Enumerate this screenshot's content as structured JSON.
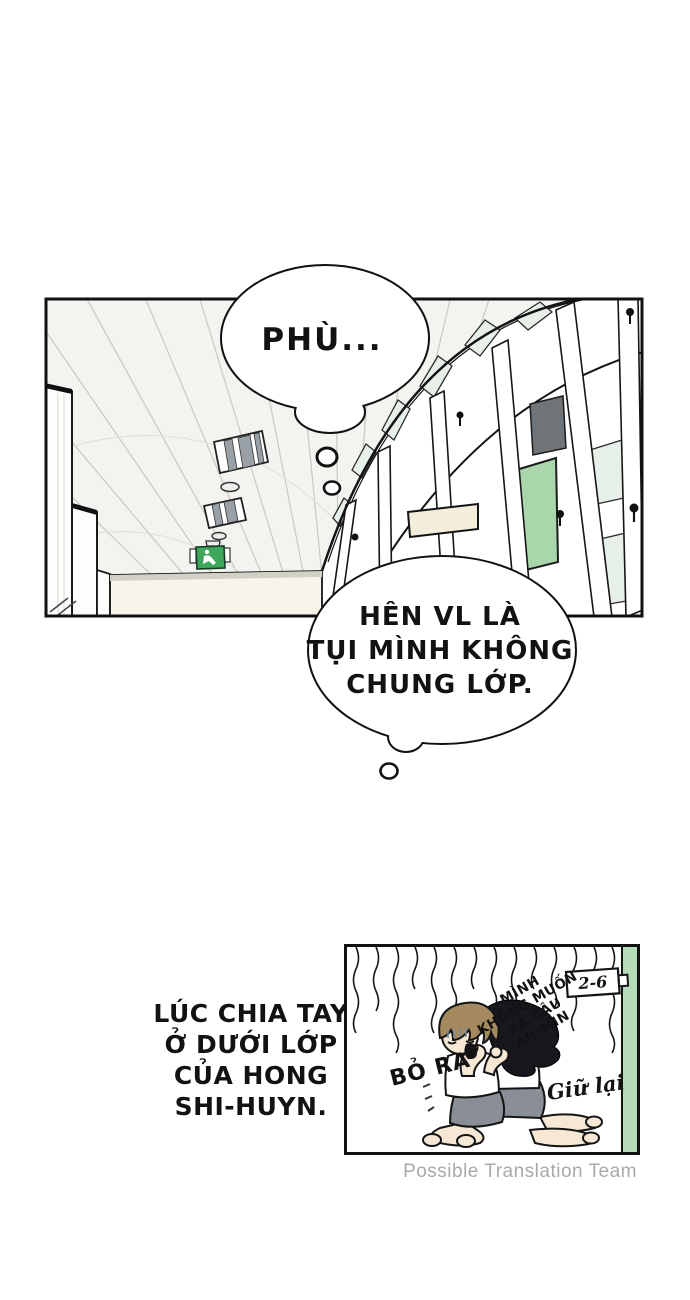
{
  "bubbles": {
    "phu": {
      "text": "PHÙ..."
    },
    "hen": {
      "lines": [
        "HÊN VL LÀ",
        "TỤI MÌNH KHÔNG",
        "CHUNG LỚP."
      ]
    }
  },
  "narration": {
    "lines": [
      "LÚC CHIA TAY",
      "Ở DƯỚI LỚP",
      "CỦA HONG",
      "SHI-HUYN."
    ]
  },
  "mini_panel": {
    "classroom_sign": "2-6",
    "clinging_text_lines": [
      "MÌNH",
      "KHÔNG MUỐN",
      "XA CẬU",
      "AH-MIN"
    ],
    "shout_text": "BỎ RA",
    "script_text": "Giữ lại"
  },
  "watermark": "Possible Translation Team",
  "icons": {
    "exit_sign": "running-man-exit-icon",
    "ceiling_lights": "fluorescent-light-icon"
  },
  "colors": {
    "exit_sign_green": "#3ea75c",
    "hall_door_green": "#a9d7ab",
    "mini_door_green": "#b7dcb9",
    "dark_pane_gray": "#6f7478",
    "glass_pale": "#e7efe9",
    "sign_cream": "#f3eedb",
    "band_cream": "#f7f4ea",
    "ceiling_gray": "#f3f3f0",
    "skirt_gray": "#8a8e96",
    "hair_brown": "#a58a60",
    "hair_black": "#17171d",
    "skin": "#f6e8d4",
    "gloom_blue": "#7d88a2",
    "watermark_gray": "#a9a9a9",
    "ink": "#121212"
  }
}
